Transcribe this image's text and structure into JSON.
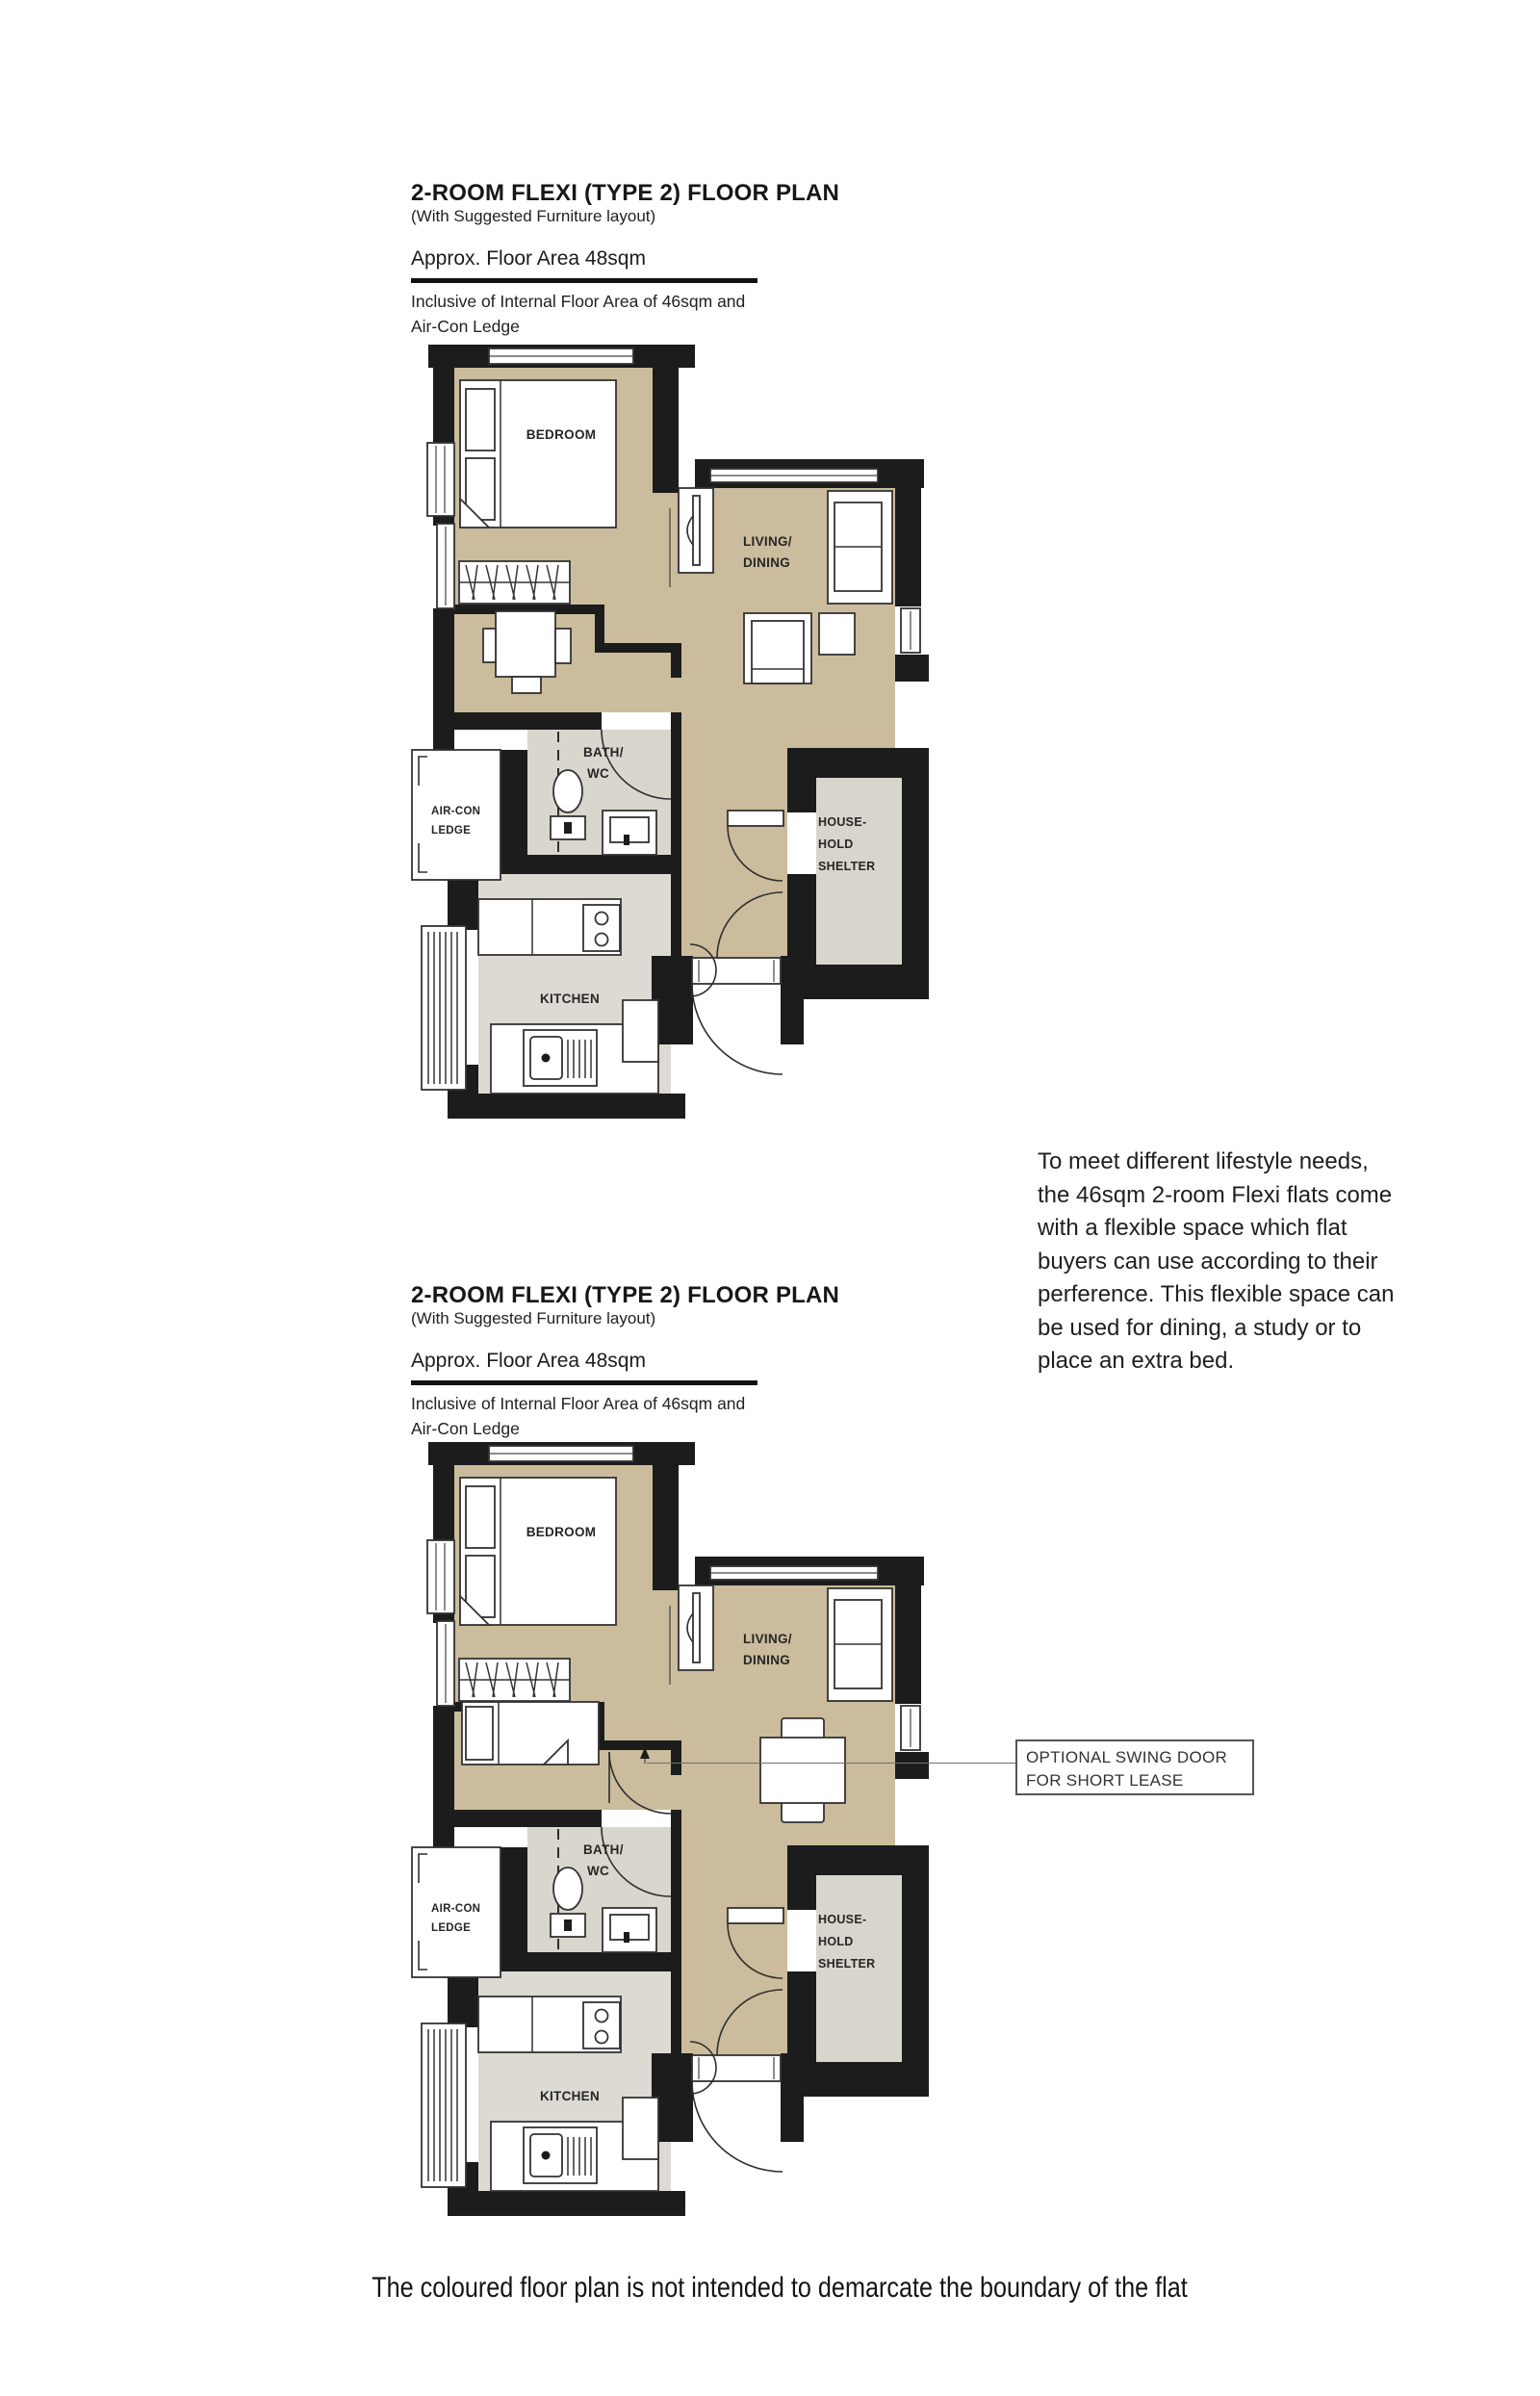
{
  "plan1": {
    "header": {
      "title": "2-ROOM FLEXI (TYPE 2) FLOOR PLAN",
      "subtitle": "(With Suggested Furniture layout)",
      "area": "Approx. Floor Area 48sqm",
      "inclusive_line1": "Inclusive of Internal Floor Area of 46sqm and",
      "inclusive_line2": "Air-Con Ledge"
    },
    "labels": {
      "bedroom": "BEDROOM",
      "living1": "LIVING/",
      "living2": "DINING",
      "bath1": "BATH/",
      "bath2": "WC",
      "kitchen": "KITCHEN",
      "aircon1": "AIR-CON",
      "aircon2": "LEDGE",
      "shelter1": "HOUSE-",
      "shelter2": "HOLD",
      "shelter3": "SHELTER"
    }
  },
  "plan2": {
    "header": {
      "title": "2-ROOM FLEXI (TYPE 2) FLOOR PLAN",
      "subtitle": "(With Suggested Furniture layout)",
      "area": "Approx. Floor Area 48sqm",
      "inclusive_line1": "Inclusive of Internal Floor Area of 46sqm and",
      "inclusive_line2": "Air-Con Ledge"
    },
    "labels": {
      "bedroom": "BEDROOM",
      "living1": "LIVING/",
      "living2": "DINING",
      "bath1": "BATH/",
      "bath2": "WC",
      "kitchen": "KITCHEN",
      "aircon1": "AIR-CON",
      "aircon2": "LEDGE",
      "shelter1": "HOUSE-",
      "shelter2": "HOLD",
      "shelter3": "SHELTER"
    }
  },
  "intro": {
    "lines": [
      "To meet different lifestyle needs,",
      "the 46sqm 2-room Flexi flats come",
      "with a flexible space which flat",
      "buyers can use according to their",
      "perference. This flexible space can",
      "be used for dining, a study or to",
      "place an extra bed."
    ]
  },
  "callout": {
    "line1": "OPTIONAL SWING DOOR",
    "line2": "FOR SHORT LEASE"
  },
  "disclaimer": "The coloured floor plan is not intended to demarcate the boundary of the flat",
  "colors": {
    "floor_beige": "#cabc9c",
    "floor_grey": "#dcdad3",
    "wall_black": "#1c1c1c"
  }
}
